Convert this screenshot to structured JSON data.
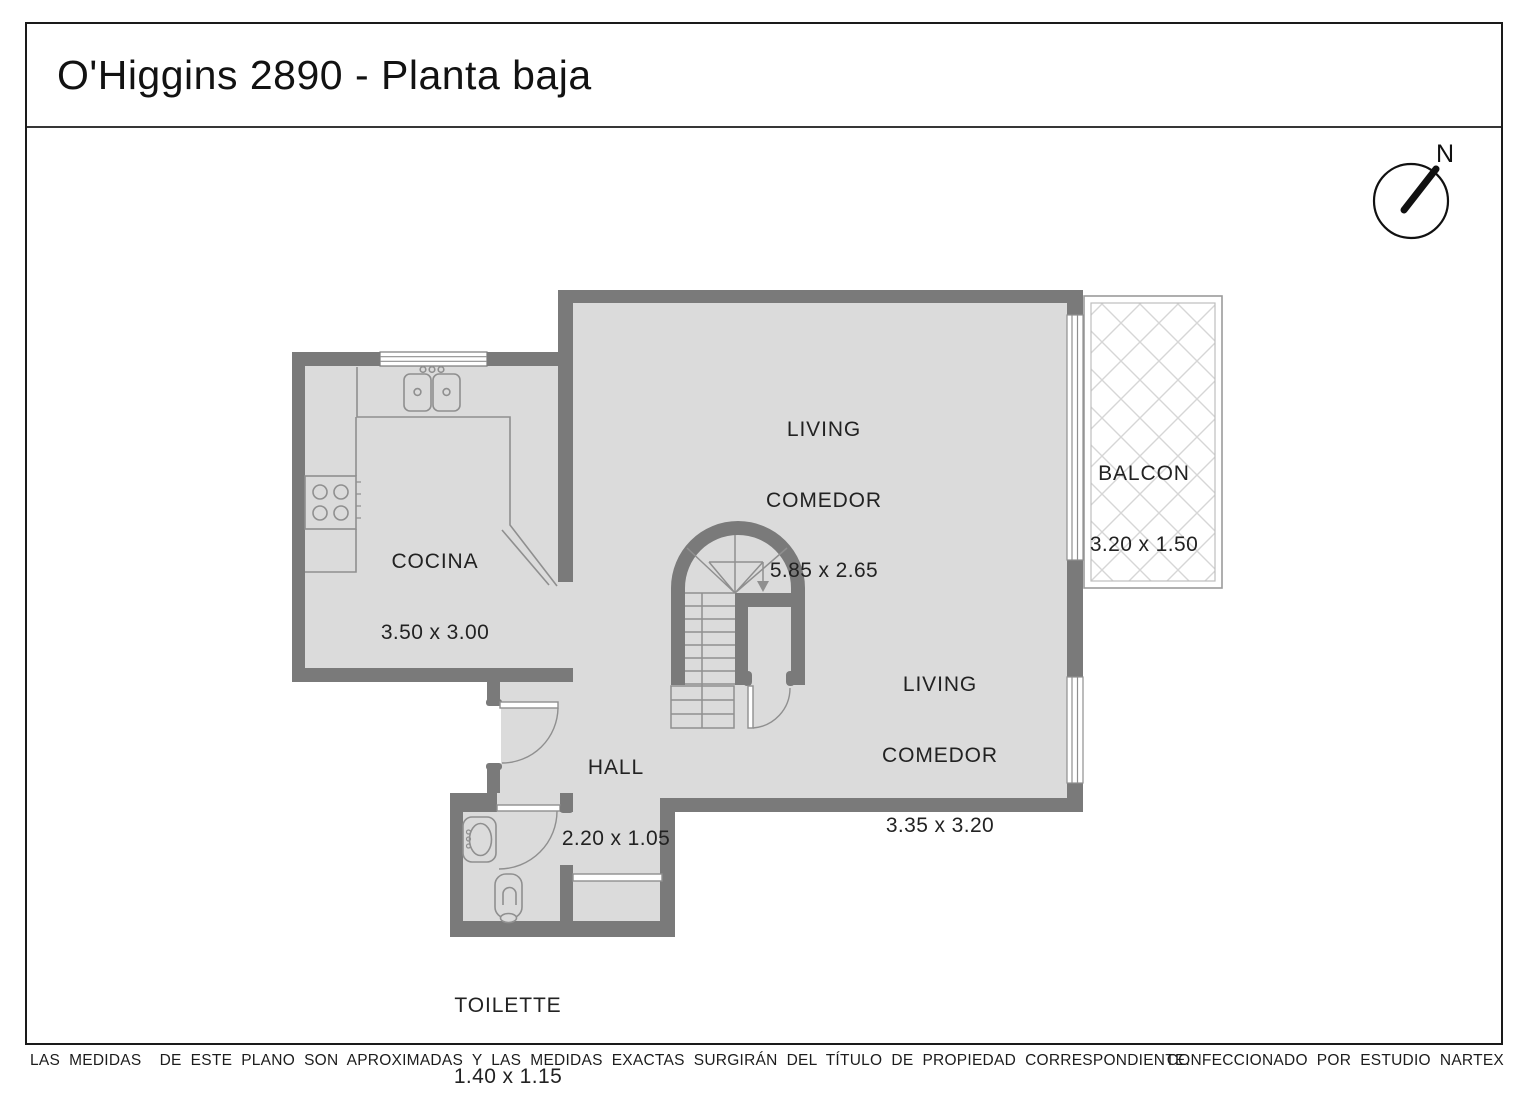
{
  "title": "O'Higgins 2890 - Planta baja",
  "compass": {
    "label": "N"
  },
  "rooms": {
    "cocina": {
      "name": "COCINA",
      "dims": "3.50 x 3.00"
    },
    "living_comedor_1": {
      "name_line1": "LIVING",
      "name_line2": "COMEDOR",
      "dims": "5.85 x 2.65"
    },
    "living_comedor_2": {
      "name_line1": "LIVING",
      "name_line2": "COMEDOR",
      "dims": "3.35 x 3.20"
    },
    "hall": {
      "name": "HALL",
      "dims": "2.20 x 1.05"
    },
    "balcon": {
      "name": "BALCON",
      "dims": "3.20 x 1.50"
    },
    "toilette": {
      "name": "TOILETTE",
      "dims": "1.40 x 1.15"
    }
  },
  "footer": {
    "disclaimer": "LAS MEDIDAS  DE ESTE PLANO SON APROXIMADAS Y LAS MEDIDAS EXACTAS SURGIRÁN DEL TÍTULO DE PROPIEDAD CORRESPONDIENTE.",
    "credit": "CONFECCIONADO POR ESTUDIO NARTEX"
  },
  "colors": {
    "wall": "#7a7a7a",
    "floor": "#dbdbdb",
    "fixture_line": "#8f8f8f",
    "hatch": "#d6d6d6",
    "border": "#1a1a1a"
  }
}
